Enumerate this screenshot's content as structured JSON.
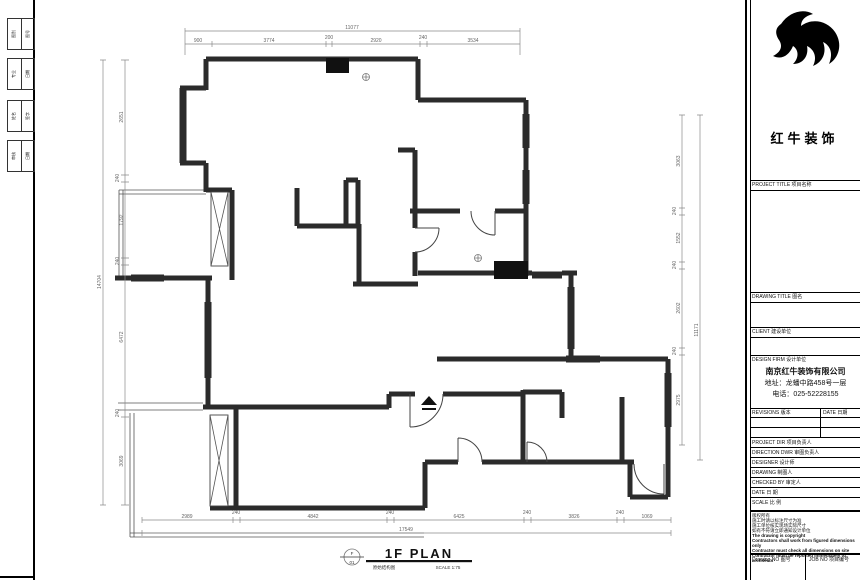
{
  "plan_footer": {
    "bubble_top": "F",
    "bubble_bottom": "01",
    "title": "1F PLAN",
    "subtitle_cn": "原始结构图",
    "scale": "SCALE 1:75"
  },
  "fold_strip": {
    "groups": [
      {
        "a": "图别",
        "b": "图号"
      },
      {
        "a": "专业",
        "b": "日期"
      },
      {
        "a": "姓名",
        "b": "签字"
      },
      {
        "a": "审核",
        "b": "日期"
      }
    ]
  },
  "dimensions": {
    "top": {
      "total": "11077",
      "segments": [
        "900",
        "3774",
        "200",
        "2920",
        "240",
        "3534"
      ]
    },
    "bottom": {
      "total": "17549",
      "segments": [
        "2989",
        "240",
        "4842",
        "240",
        "6425",
        "240",
        "3826",
        "240",
        "1069"
      ]
    },
    "left": {
      "total": "14704",
      "segments": [
        "2651",
        "240",
        "1792",
        "240",
        "6472",
        "240",
        "3069"
      ]
    },
    "right": {
      "total": "11171",
      "segments": [
        "3063",
        "240",
        "1552",
        "240",
        "2602",
        "240",
        "2975"
      ]
    }
  },
  "title_block": {
    "logo_text": "红牛装饰",
    "section_labels": {
      "project_title": "PROJECT TITLE  项目名称",
      "drawing_title": "DRAWING TITLE  图名",
      "client": "CLIENT  建设单位",
      "design_firm": "DESIGN FIRM  设计单位"
    },
    "company": {
      "name": "南京红牛装饰有限公司",
      "address": "地址：龙蟠中路458号一层",
      "phone": "电话：025-52228155"
    },
    "revisions_header": {
      "rev": "REVISIONS  版本",
      "date": "DATE 日期"
    },
    "info_rows": [
      "PROJECT DIR  项目负责人",
      "DIRECTION DWR  审图负责人",
      "DESIGNER  设计师",
      "DRAWING  制图人",
      "CHECKED BY  审定人",
      "DATE  日  期",
      "SCALE  比  例"
    ],
    "notes_cn": [
      "版权所有",
      "施工时请以标注尺寸为准",
      "施工单位核实现场实际尺寸",
      "如有不符请立即通知设计单位"
    ],
    "notes_en": [
      "The drawing is copyright",
      "Contractors shall work from figured dimensions only",
      "Contractor must check all dimensions on site",
      "Contractor must be reported immediately to architects"
    ],
    "drawing_no_label": "Drawing NO  图号",
    "job_no_label": "JOB NO  项目编号"
  }
}
